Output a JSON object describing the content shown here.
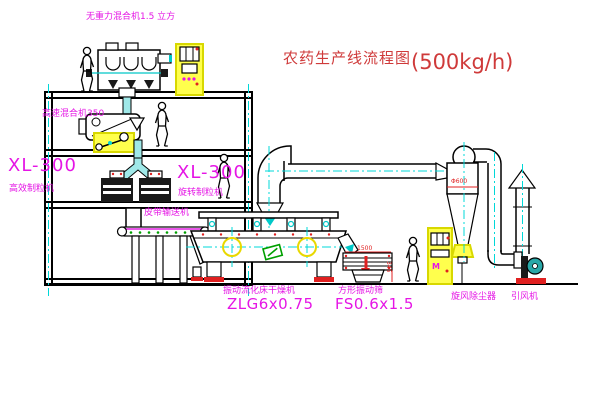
{
  "title": {
    "text": "农药生产线流程图",
    "capacity": "(500kg/h)"
  },
  "equipment_labels": {
    "gravity_mixer": "无重力混合机1.5 立方",
    "high_speed_mixer": "高速混合机350",
    "granulator_left_model": "XL-300",
    "granulator_left_name": "高效制粒机",
    "granulator_mid_model": "XL-300",
    "granulator_mid_name": "旋转制粒机",
    "belt_conveyor": "皮带输送机",
    "dryer_name": "振动流化床干燥机",
    "dryer_model": "ZLG6x0.75",
    "screen_name": "方形振动筛",
    "screen_model": "FS0.6x1.5",
    "cyclone": "旋风除尘器",
    "fan": "引风机"
  },
  "dimensions": {
    "screen_length": "1500",
    "screen_height": "345",
    "cyclone_diameter": "Φ600"
  },
  "annotations": {
    "cabinet_mark": "M"
  },
  "colors": {
    "title_red": "#cf3a3a",
    "label_magenta": "#e515e5",
    "dimension_red": "#e02020",
    "centerline_cyan": "#00d8d8",
    "pipe_teal": "#9fe8e8",
    "highlight_yellow": "#ffff4d",
    "accent_green": "#00a000"
  }
}
